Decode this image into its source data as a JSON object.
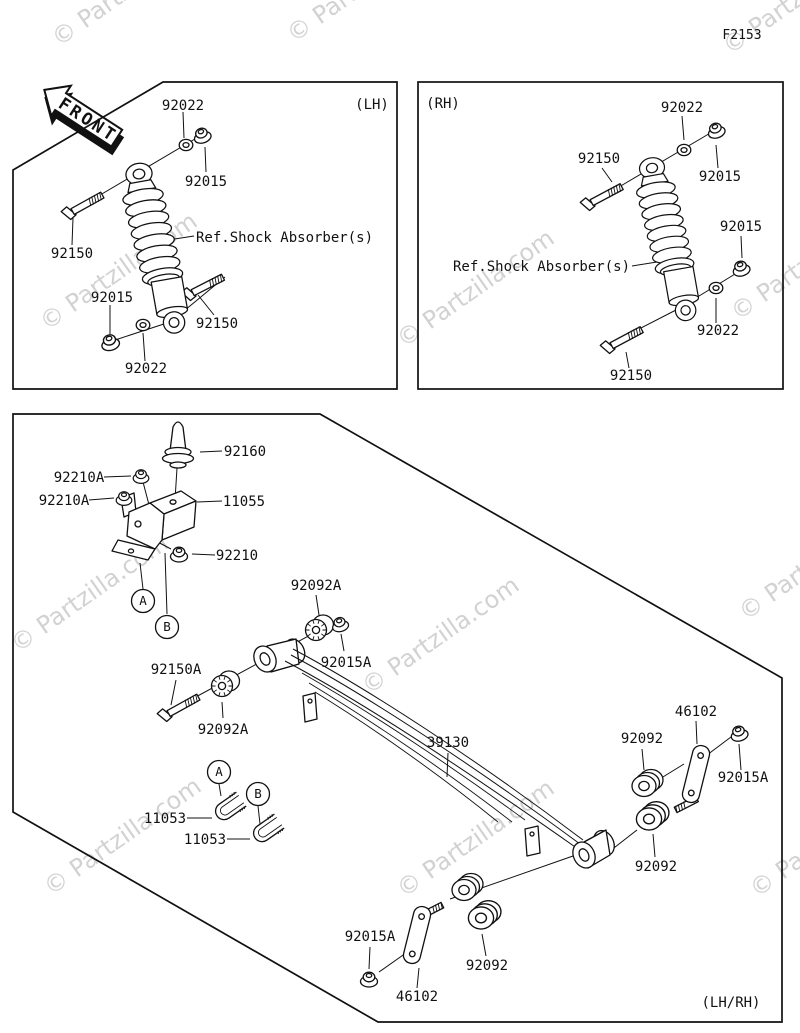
{
  "figure_code": "F2153",
  "front_arrow_label": "FRONT",
  "watermark_text": "© Partzilla.com",
  "panel_tags": {
    "lh": "(LH)",
    "rh": "(RH)",
    "main": "(LH/RH)"
  },
  "ref_note": "Ref.Shock Absorber(s)",
  "callouts": {
    "a": "A",
    "b": "B"
  },
  "part_numbers": {
    "nut_flanged": "92015",
    "washer": "92022",
    "bolt_shock": "92150",
    "damper_rubber": "92160",
    "bracket_comp": "11055",
    "nut_bracket": "92210A",
    "nut_lock": "92210",
    "bushing_splined": "92092A",
    "nut_small_flanged": "92015A",
    "bolt_spring_pivot": "92150A",
    "leaf_spring_comp": "39130",
    "bolt_u": "11053",
    "plate_shackle": "46102",
    "bushing_rubber": "92092"
  }
}
